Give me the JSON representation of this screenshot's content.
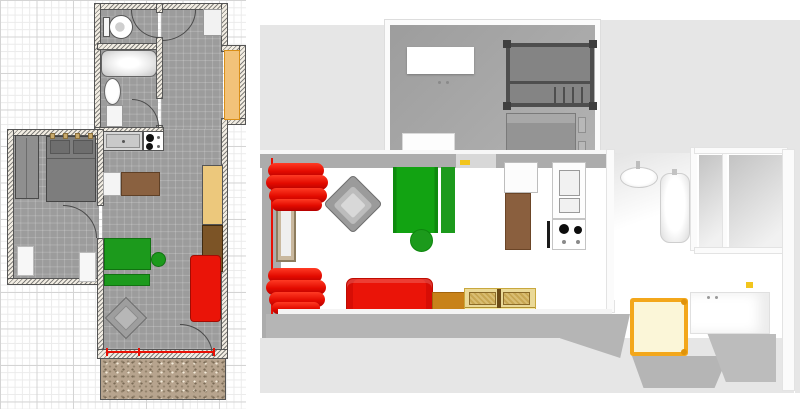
{
  "app": {
    "view": "home-design-dual-view",
    "left_panel": "2D floor plan on squared grid paper",
    "right_panel": "3D aerial view of the same apartment"
  },
  "colors": {
    "grid_line": "#d4d4d4",
    "plan_floor_gray": "#9c9c9c",
    "wall_fill": "#f2ede3",
    "selected_red": "#e90f04",
    "sofa_red": "#ea1408",
    "sofa_green": "#1c9a1c",
    "sofa_green_dark": "#117211",
    "closet_orange_fill": "#f2c279",
    "closet_orange_border": "#d98e17",
    "wardrobe_tan": "#ecc87c",
    "wardrobe_brown": "#7c5426",
    "table_brown": "#8a6140",
    "cabinet_orange_brown": "#c8821a",
    "chest_pale_yellow": "#f6e9a4",
    "chest_rim": "#c9a83d",
    "basket_weave": "#d9bd72",
    "shower_yellow_frame": "#f3a71b",
    "shower_pale_fill": "#fbf6d8",
    "terrace_speckle": "#b7a48e",
    "terrace3d_gray": "#b5b5b5",
    "outside3d_gray": "#e6e6e6",
    "bed_gray_2d": "#7d7d7d",
    "bed_gray_3d": "#989898",
    "bunk_frame_dark": "#4e4e4e",
    "armchair_gray": "#9b9b9b",
    "window_frame_tan": "#c9b89e",
    "wall_light_yellow": "#f2c51d"
  },
  "plan2d": {
    "rooms": [
      {
        "name": "toilet-room"
      },
      {
        "name": "bathroom"
      },
      {
        "name": "entry-hall"
      },
      {
        "name": "bedroom"
      },
      {
        "name": "kitchen-living-room"
      },
      {
        "name": "terrace"
      }
    ],
    "furniture": [
      {
        "name": "toilet"
      },
      {
        "name": "bathtub"
      },
      {
        "name": "pedestal-sink"
      },
      {
        "name": "bathroom-cabinet"
      },
      {
        "name": "hall-cabinet"
      },
      {
        "name": "wall-closet",
        "color": "#f2c279"
      },
      {
        "name": "kitchen-sink"
      },
      {
        "name": "stove-two-burners"
      },
      {
        "name": "side-table-white"
      },
      {
        "name": "dining-table-brown",
        "color": "#8a6140"
      },
      {
        "name": "wardrobe-tan",
        "color": "#ecc87c"
      },
      {
        "name": "wardrobe-brown",
        "color": "#7c5426"
      },
      {
        "name": "sofa-bed-green",
        "color": "#1c9a1c"
      },
      {
        "name": "pouf-green",
        "color": "#1c9a1c"
      },
      {
        "name": "sofa-red",
        "color": "#ea1408"
      },
      {
        "name": "coffee-table-diamond"
      },
      {
        "name": "double-bed-gray"
      },
      {
        "name": "bedroom-wardrobe-gray"
      },
      {
        "name": "radiator-white",
        "count": 2
      },
      {
        "name": "selected-window",
        "color": "#e90f04"
      }
    ],
    "doors": [
      "toilet-door",
      "hall-entrance-door",
      "bathroom-door",
      "bedroom-door",
      "terrace-door"
    ]
  },
  "view3d": {
    "rooms": [
      {
        "name": "bedroom-3d",
        "floor": "#a6a6a6"
      },
      {
        "name": "living-room-3d",
        "floor": "#ffffff"
      },
      {
        "name": "kitchen-3d",
        "floor": "#ffffff"
      },
      {
        "name": "bathroom-3d",
        "floor": "#ffffff"
      },
      {
        "name": "hall-rooms-3d",
        "floor": "gradient-gray"
      },
      {
        "name": "terrace-3d",
        "floor": "#b5b5b5"
      }
    ],
    "furniture": [
      {
        "name": "white-wardrobe"
      },
      {
        "name": "bunk-bed-dark-gray",
        "color": "#4e4e4e"
      },
      {
        "name": "double-bed-gray",
        "color": "#989898"
      },
      {
        "name": "bedroom-door-white"
      },
      {
        "name": "red-curtain-upper",
        "color": "#e30b00"
      },
      {
        "name": "red-curtain-lower",
        "color": "#e30b00"
      },
      {
        "name": "window-door-tan",
        "color": "#c9b89e"
      },
      {
        "name": "armchair-gray",
        "color": "#9b9b9b"
      },
      {
        "name": "sofa-bed-green",
        "color": "#12a312"
      },
      {
        "name": "pouf-green",
        "color": "#12a312"
      },
      {
        "name": "wall-light-yellow",
        "color": "#f2c51d"
      },
      {
        "name": "fridge-top-white"
      },
      {
        "name": "kitchen-cabinet-brown",
        "color": "#8a5f3e"
      },
      {
        "name": "fridge-unit-white"
      },
      {
        "name": "stove-two-burners"
      },
      {
        "name": "sofa-red",
        "color": "#ee1105"
      },
      {
        "name": "cabinet-orange-brown",
        "color": "#c8821a"
      },
      {
        "name": "chest-pale-yellow",
        "color": "#f6e9a4"
      },
      {
        "name": "bathroom-sink-oval"
      },
      {
        "name": "bathtub-white"
      },
      {
        "name": "shower-yellow-frame",
        "color": "#f3a71b"
      },
      {
        "name": "sink-counter-white"
      },
      {
        "name": "faucet-yellow-small",
        "color": "#e8b400"
      }
    ]
  }
}
